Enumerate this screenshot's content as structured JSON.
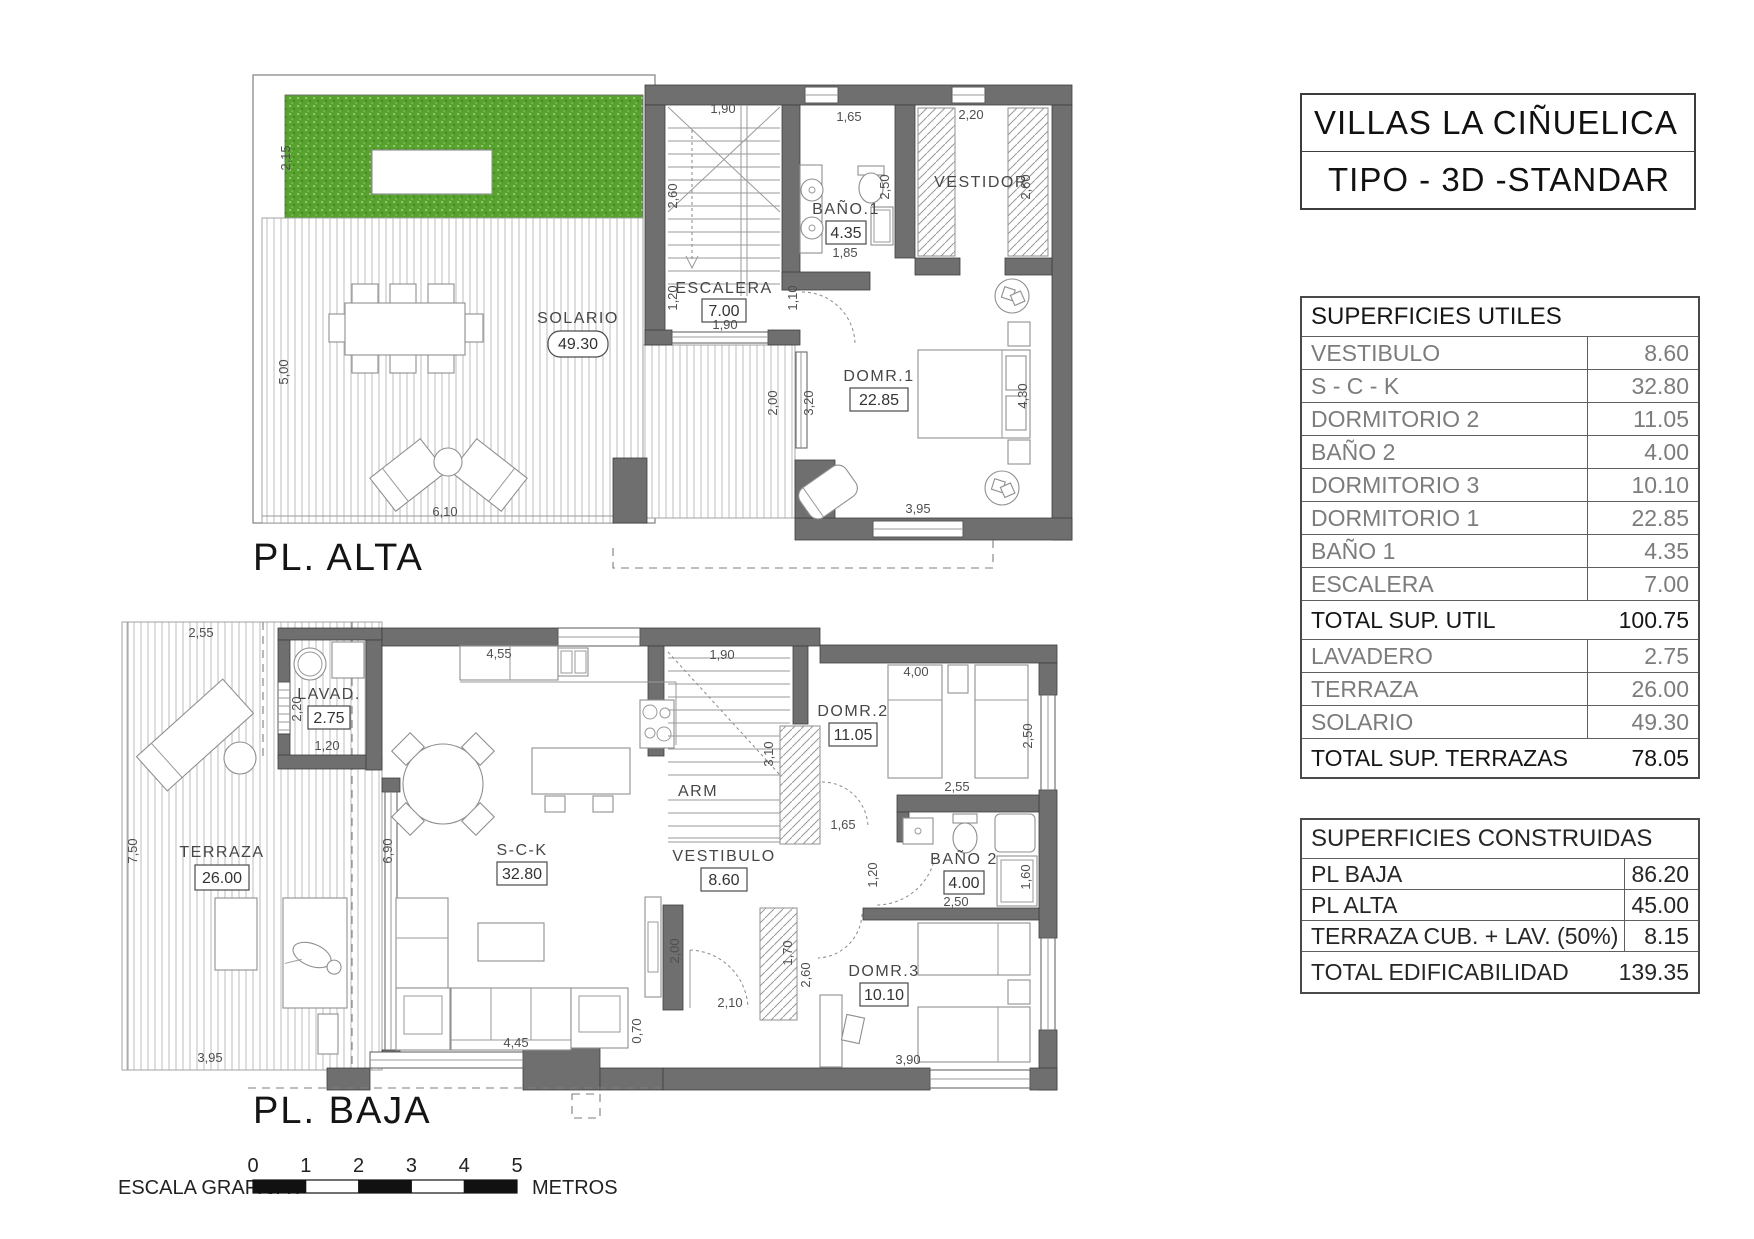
{
  "title_block": {
    "line1": "VILLAS LA CIÑUELICA",
    "line2": "TIPO - 3D -STANDAR"
  },
  "superficies_utiles": {
    "header": "SUPERFICIES UTILES",
    "rows": [
      {
        "label": "VESTIBULO",
        "value": "8.60"
      },
      {
        "label": "S - C - K",
        "value": "32.80"
      },
      {
        "label": "DORMITORIO 2",
        "value": "11.05"
      },
      {
        "label": "BAÑO 2",
        "value": "4.00"
      },
      {
        "label": "DORMITORIO 3",
        "value": "10.10"
      },
      {
        "label": "DORMITORIO 1",
        "value": "22.85"
      },
      {
        "label": "BAÑO 1",
        "value": "4.35"
      },
      {
        "label": "ESCALERA",
        "value": "7.00"
      }
    ],
    "total_util": {
      "label": "TOTAL SUP. UTIL",
      "value": "100.75"
    },
    "rows2": [
      {
        "label": "LAVADERO",
        "value": "2.75"
      },
      {
        "label": "TERRAZA",
        "value": "26.00"
      },
      {
        "label": "SOLARIO",
        "value": "49.30"
      }
    ],
    "total_terrazas": {
      "label": "TOTAL SUP. TERRAZAS",
      "value": "78.05"
    }
  },
  "superficies_construidas": {
    "header": "SUPERFICIES CONSTRUIDAS",
    "rows": [
      {
        "label": "PL BAJA",
        "value": "86.20"
      },
      {
        "label": "PL ALTA",
        "value": "45.00"
      },
      {
        "label": "TERRAZA CUB. + LAV. (50%)",
        "value": "8.15"
      }
    ],
    "total": {
      "label": "TOTAL EDIFICABILIDAD",
      "value": "139.35"
    }
  },
  "plan_alta": {
    "title": "PL. ALTA",
    "rooms": {
      "solario": {
        "name": "SOLARIO",
        "value": "49.30"
      },
      "escalera": {
        "name": "ESCALERA",
        "value": "7.00"
      },
      "bano1": {
        "name": "BAÑO.1",
        "value": "4.35"
      },
      "vestidor": {
        "name": "VESTIDOR"
      },
      "domr1": {
        "name": "DOMR.1",
        "value": "22.85"
      }
    },
    "dims": [
      "2,15",
      "5,00",
      "6,10",
      "1,90",
      "2,60",
      "1,20",
      "1,90",
      "1,10",
      "1,65",
      "2,50",
      "1,85",
      "2,20",
      "2,60",
      "2,00",
      "3,20",
      "4,30",
      "3,95"
    ]
  },
  "plan_baja": {
    "title": "PL. BAJA",
    "rooms": {
      "lavadero": {
        "name": "LAVAD.",
        "value": "2.75"
      },
      "terraza": {
        "name": "TERRAZA",
        "value": "26.00"
      },
      "sck": {
        "name": "S-C-K",
        "value": "32.80"
      },
      "arm": {
        "name": "ARM"
      },
      "domr2": {
        "name": "DOMR.2",
        "value": "11.05"
      },
      "vestibulo": {
        "name": "VESTIBULO",
        "value": "8.60"
      },
      "bano2": {
        "name": "BAÑO 2",
        "value": "4.00"
      },
      "domr3": {
        "name": "DOMR.3",
        "value": "10.10"
      }
    },
    "dims": [
      "2,55",
      "7,50",
      "3,95",
      "2,20",
      "1,20",
      "4,55",
      "6,90",
      "1,90",
      "3,10",
      "1,65",
      "4,00",
      "2,50",
      "2,55",
      "1,20",
      "2,50",
      "1,60",
      "2,00",
      "1,70",
      "2,60",
      "2,10",
      "0,70",
      "4,45",
      "3,90"
    ]
  },
  "scale_bar": {
    "label": "ESCALA GRAFICA :",
    "ticks": [
      "0",
      "1",
      "2",
      "3",
      "4",
      "5"
    ],
    "unit": "METROS"
  },
  "colors": {
    "wall": "#6f6f6f",
    "grass": "#57a32e",
    "line_gray": "#8f8f8f",
    "text_gray": "#7c7c7c",
    "text_dark": "#161616"
  }
}
